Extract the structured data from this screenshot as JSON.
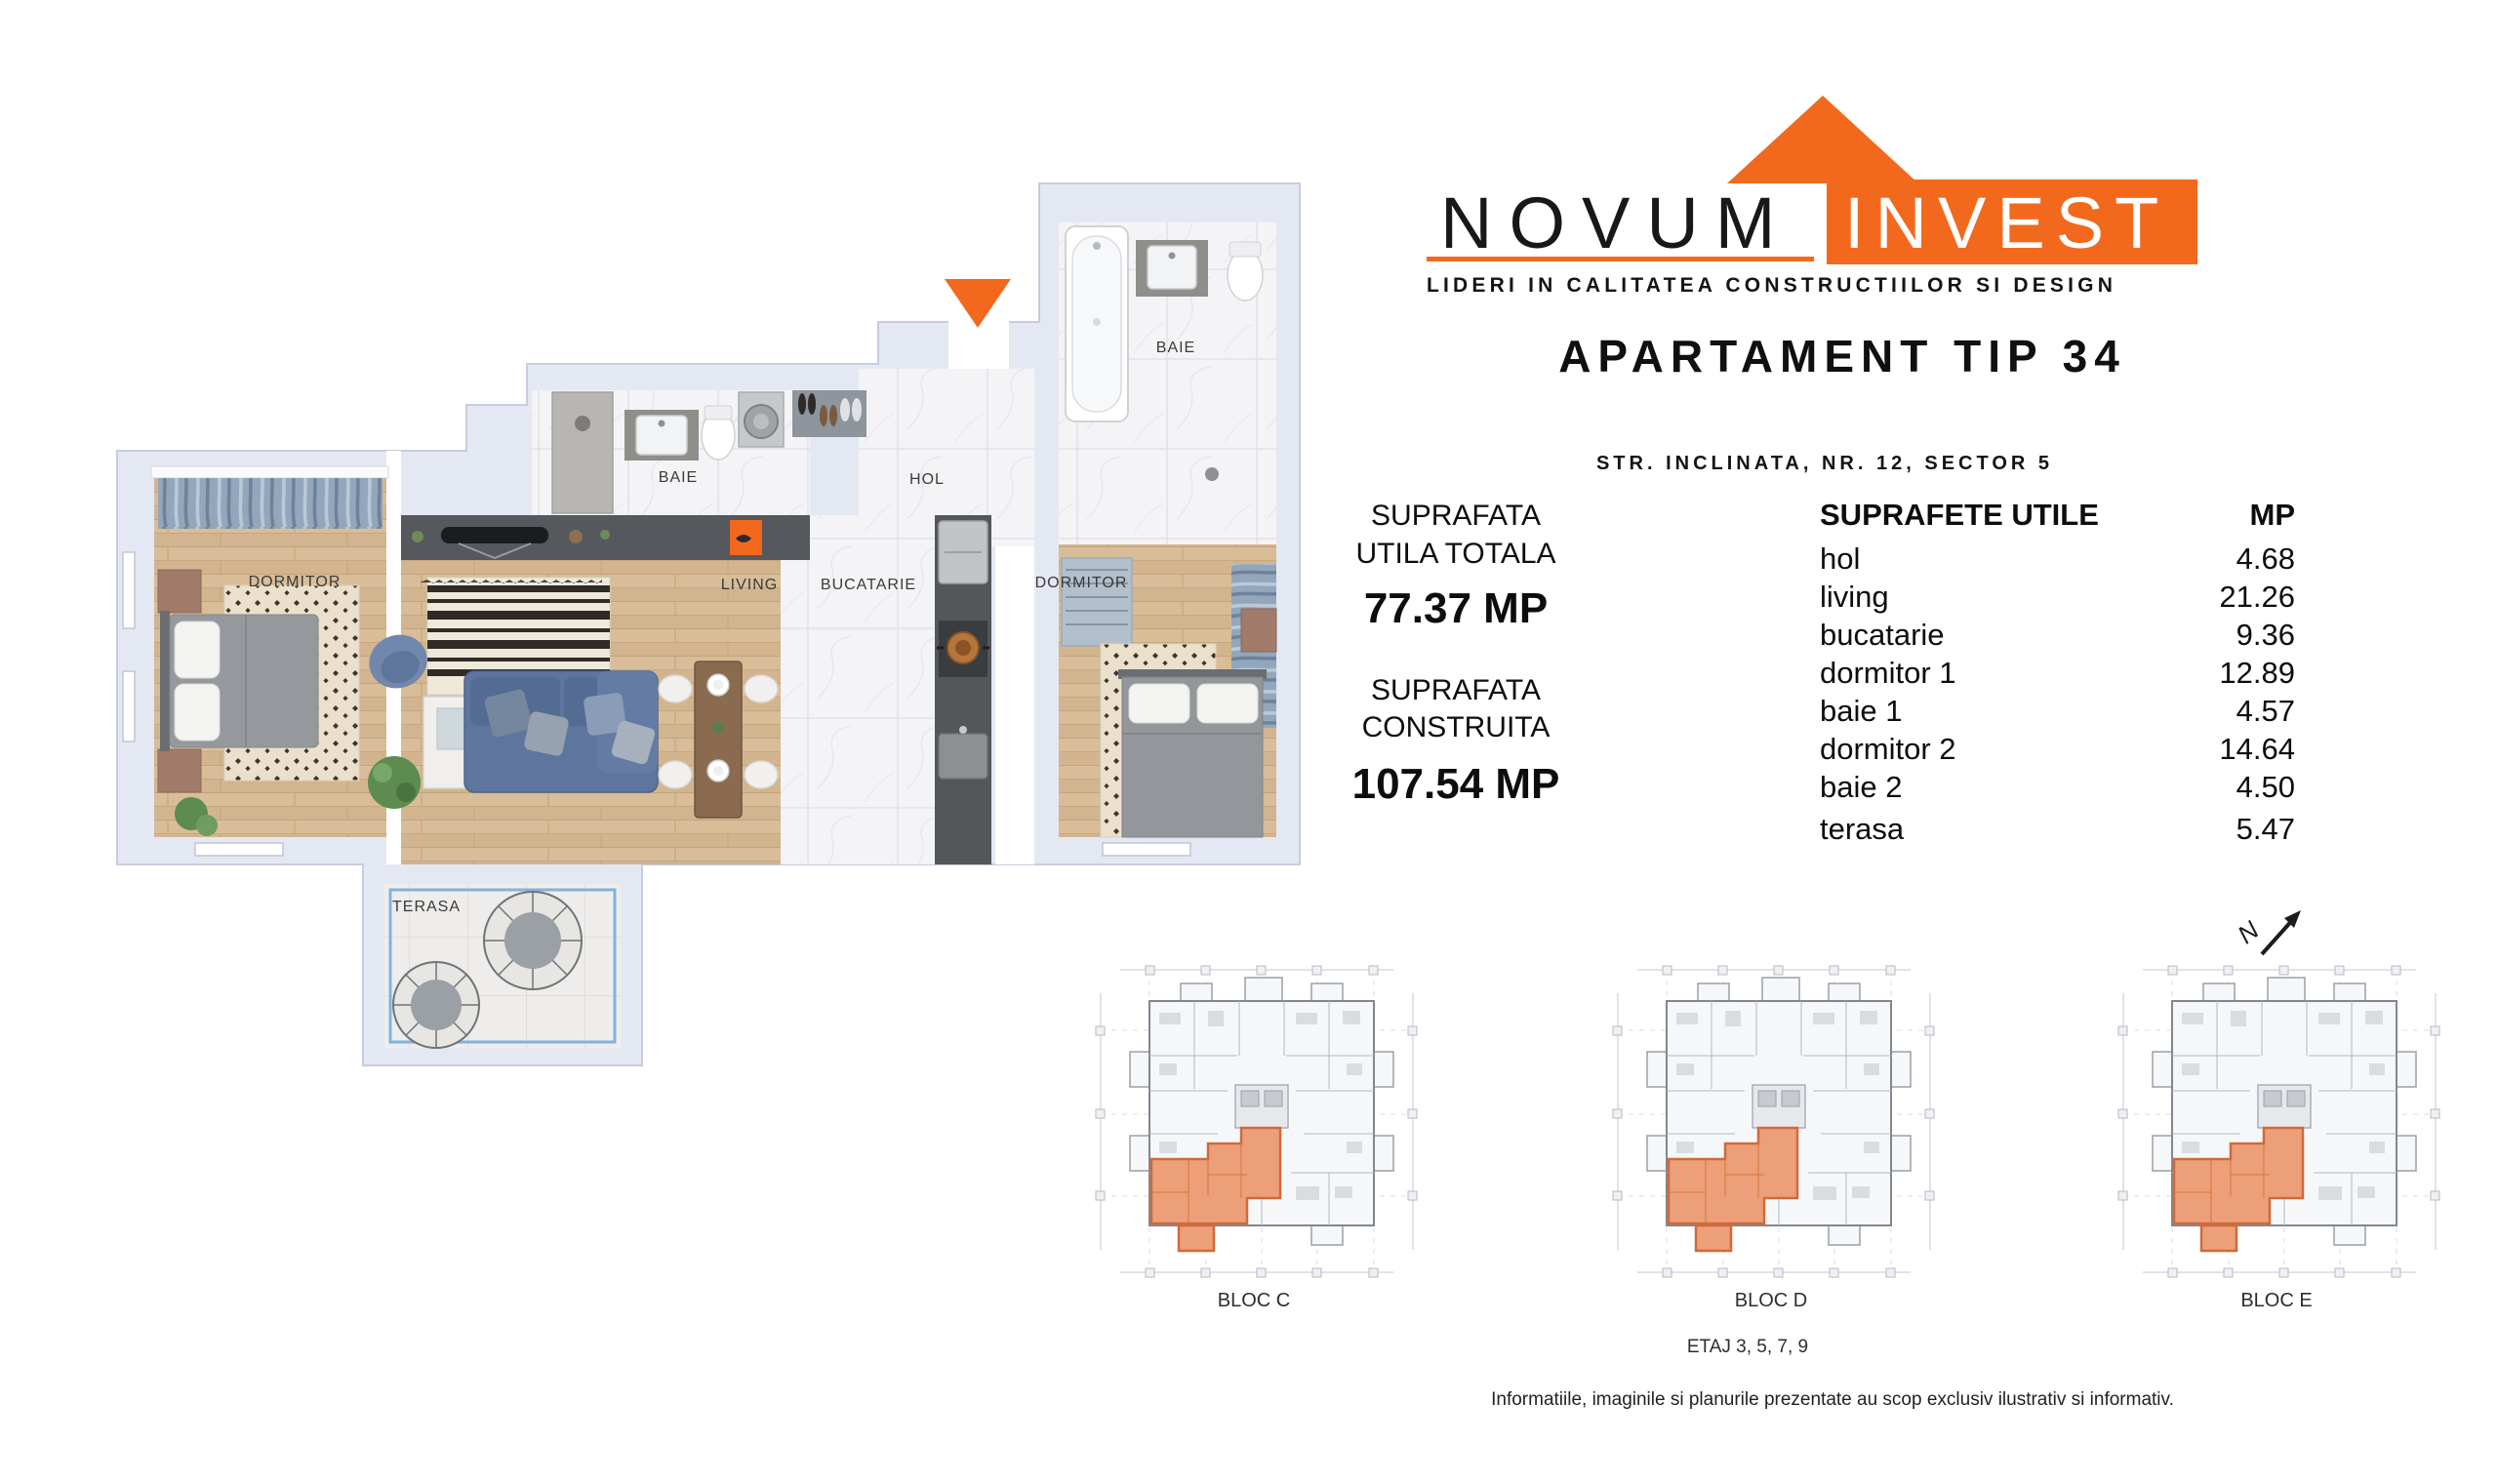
{
  "logo": {
    "brand_left": "NOVUM",
    "brand_right": "INVEST",
    "tagline": "LIDERI IN CALITATEA CONSTRUCTIILOR SI DESIGN"
  },
  "header": {
    "title": "APARTAMENT TIP 34",
    "address": "STR. INCLINATA, NR. 12, SECTOR 5"
  },
  "summary": {
    "useful_label_line1": "SUPRAFATA",
    "useful_label_line2": "UTILA TOTALA",
    "useful_value": "77.37 MP",
    "built_label_line1": "SUPRAFATA",
    "built_label_line2": "CONSTRUITA",
    "built_value": "107.54 MP"
  },
  "areas": {
    "header_label": "SUPRAFETE UTILE",
    "header_unit": "MP",
    "rows": [
      {
        "name": "hol",
        "mp": "4.68"
      },
      {
        "name": "living",
        "mp": "21.26"
      },
      {
        "name": "bucatarie",
        "mp": "9.36"
      },
      {
        "name": "dormitor 1",
        "mp": "12.89"
      },
      {
        "name": "baie 1",
        "mp": "4.57"
      },
      {
        "name": "dormitor 2",
        "mp": "14.64"
      },
      {
        "name": "baie 2",
        "mp": "4.50"
      },
      {
        "name": "terasa",
        "mp": "5.47"
      }
    ]
  },
  "floorplan": {
    "labels": {
      "dormitor1": "DORMITOR",
      "baie1": "BAIE",
      "hol": "HOL",
      "living": "LIVING",
      "bucatarie": "BUCATARIE",
      "dormitor2": "DORMITOR",
      "baie2": "BAIE",
      "terasa": "TERASA"
    },
    "north_label": "N"
  },
  "blocks": {
    "items": [
      {
        "label": "BLOC C"
      },
      {
        "label": "BLOC D"
      },
      {
        "label": "BLOC E"
      }
    ],
    "floors_note": "ETAJ 3, 5, 7, 9"
  },
  "footer": {
    "disclaimer": "Informatiile, imaginile si planurile prezentate au scop exclusiv ilustrativ si informativ."
  },
  "colors": {
    "accent_orange": "#F2691D",
    "footprint": "#E4E8F3",
    "highlight_apartment": "#EC9F78"
  }
}
